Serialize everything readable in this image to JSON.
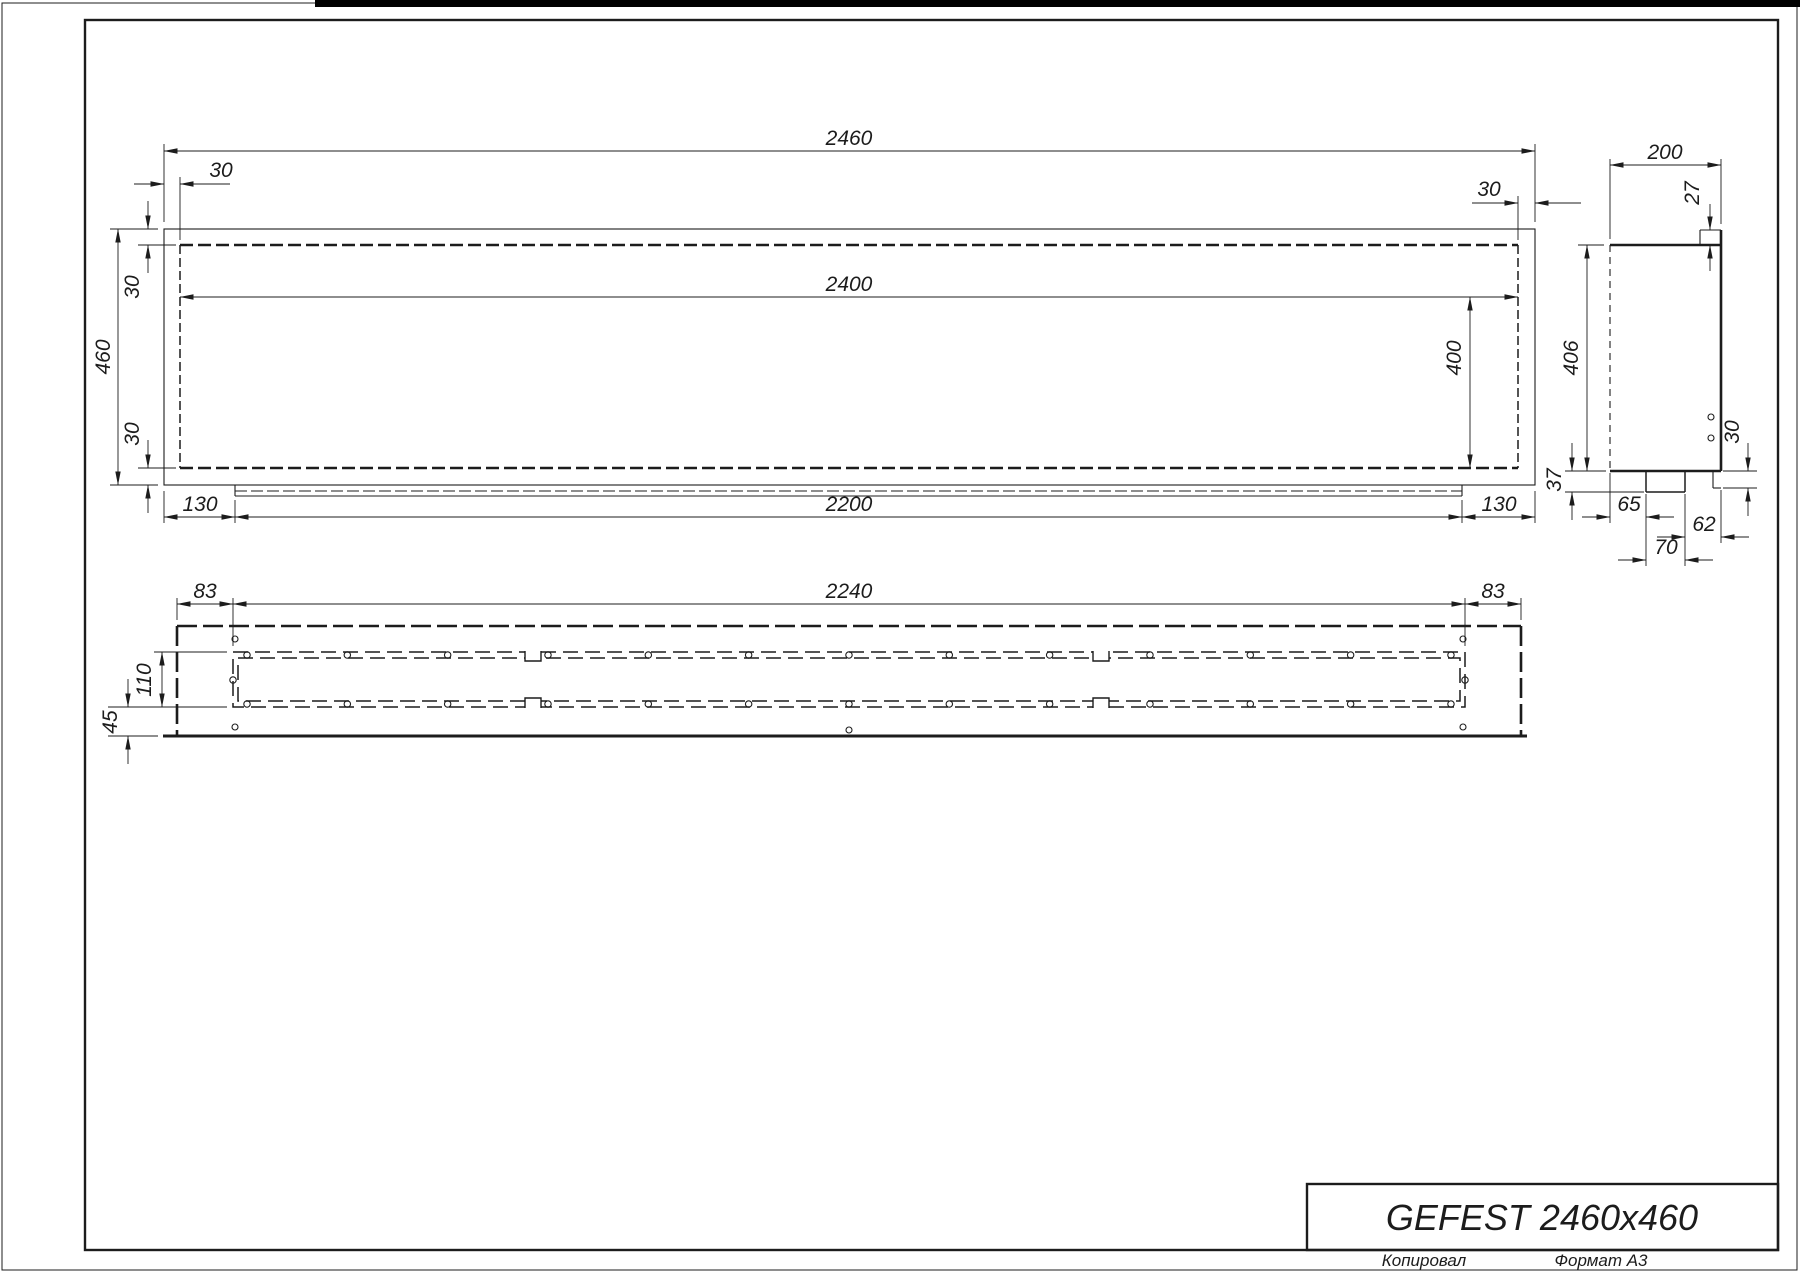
{
  "drawing": {
    "title": "GEFEST 2460x460",
    "footer": {
      "copied": "Копировал",
      "format": "Формат А3"
    },
    "front_view": {
      "dims": {
        "total_width": "2460",
        "inner_width": "2400",
        "total_height": "460",
        "top_left_inset": "30",
        "top_right_inset": "30",
        "left_top_inset": "30",
        "left_bottom_inset": "30",
        "inner_height": "400",
        "lip_left_offset": "130",
        "lip_length": "2200",
        "lip_right_offset": "130"
      }
    },
    "side_view": {
      "dims": {
        "depth": "200",
        "flange_height": "27",
        "body_height": "406",
        "foot_height": "37",
        "edge_drop": "30",
        "pipe_offset": "65",
        "pipe_to_edge": "62",
        "pipe_width": "70"
      }
    },
    "bottom_view": {
      "dims": {
        "left_margin": "83",
        "slot_length": "2240",
        "right_margin": "83",
        "slot_width": "110",
        "edge_offset": "45"
      }
    },
    "colors": {
      "line": "#1c1c1c",
      "paper": "#ffffff"
    }
  }
}
